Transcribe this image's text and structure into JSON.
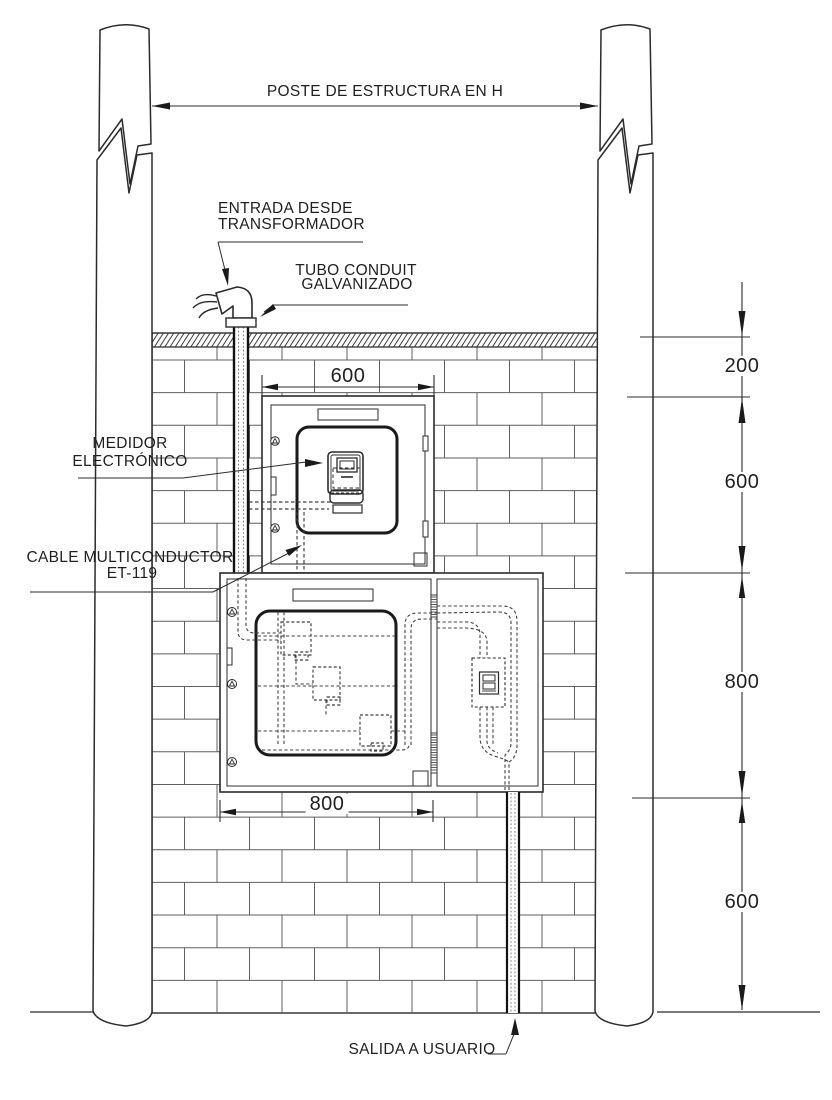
{
  "drawing": {
    "labels": {
      "poste": "POSTE DE ESTRUCTURA EN H",
      "entrada_1": "ENTRADA DESDE",
      "entrada_2": "TRANSFORMADOR",
      "tubo_1": "TUBO CONDUIT",
      "tubo_2": "GALVANIZADO",
      "medidor_1": "MEDIDOR",
      "medidor_2": "ELECTRÓNICO",
      "cable_1": "CABLE MULTICONDUCTOR",
      "cable_2": "ET-119",
      "salida": "SALIDA A USUARIO"
    },
    "dimensions": {
      "meter_box_width": "600",
      "distribution_box_width": "800",
      "chain": [
        {
          "value": "200"
        },
        {
          "value": "600"
        },
        {
          "value": "800"
        },
        {
          "value": "600"
        }
      ]
    },
    "colors": {
      "line": "#2b2b2b",
      "brick_line": "#5f5f5f",
      "cable_dashed": "#3f3f3f",
      "background": "#ffffff"
    }
  }
}
